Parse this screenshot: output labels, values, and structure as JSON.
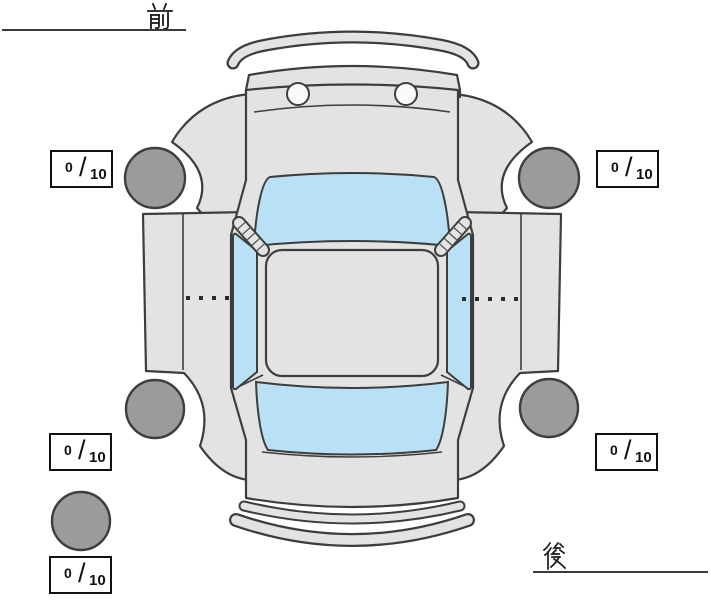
{
  "diagram": {
    "title": "car-top-view-tire-tread-diagram",
    "front_label": "前",
    "rear_label": "後",
    "score_separator": "/",
    "scores": {
      "front_left": {
        "value": "0",
        "max": "10"
      },
      "front_right": {
        "value": "0",
        "max": "10"
      },
      "rear_left": {
        "value": "0",
        "max": "10"
      },
      "rear_right": {
        "value": "0",
        "max": "10"
      },
      "spare": {
        "value": "0",
        "max": "10"
      }
    },
    "colors": {
      "background": "#ffffff",
      "body": "#e3e3e3",
      "outline": "#3d3d3d",
      "glass": "#b9e0f5",
      "tire": "#9b9b9b",
      "score_box_border": "#111111"
    }
  }
}
